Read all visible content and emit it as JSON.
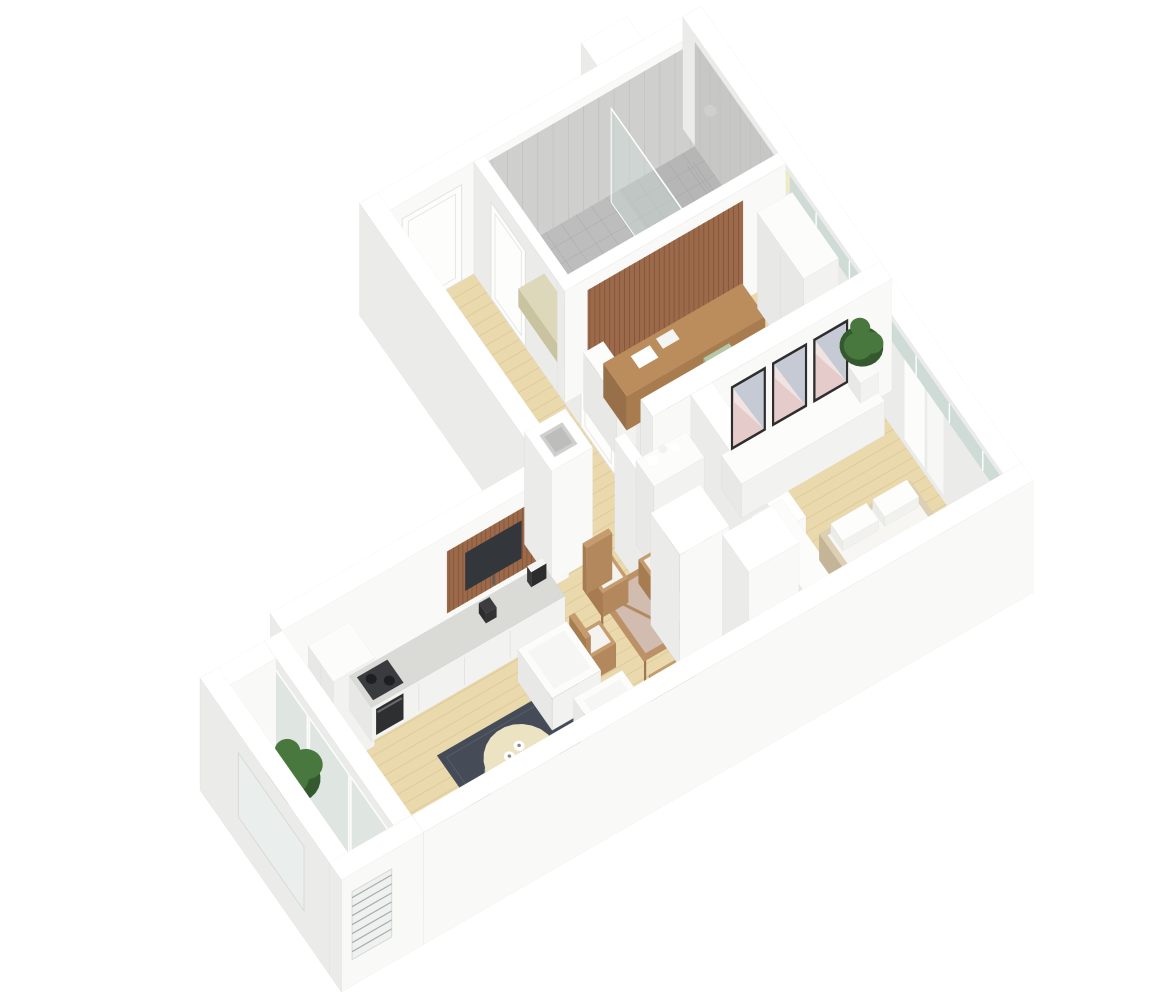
{
  "page": {
    "title": "3D isometric apartment floor plan render"
  },
  "scene": {
    "background": "#ffffff",
    "rooms": [
      {
        "name": "hallway",
        "furniture": [
          "entry-door",
          "bathroom-door",
          "study-door",
          "installation-shaft"
        ]
      },
      {
        "name": "bathroom",
        "furniture": [
          "gray-tile-floor",
          "tile-walls",
          "shower-head",
          "glass-screen",
          "bench-shelf",
          "wall-niche",
          "drain"
        ]
      },
      {
        "name": "study",
        "furniture": [
          "wood-slat-panel",
          "desk",
          "desk-papers",
          "green-chair",
          "green-chair",
          "wardrobe",
          "bench"
        ]
      },
      {
        "name": "wc",
        "furniture": [
          "tall-cabinet",
          "washbasin",
          "toilet",
          "washing-machine",
          "terracotta-floor"
        ]
      },
      {
        "name": "bedroom",
        "furniture": [
          "sideboard",
          "art-frame",
          "art-frame",
          "art-frame",
          "potted-plant",
          "low-bench",
          "double-bed",
          "pillows",
          "curtains",
          "window-strip"
        ]
      },
      {
        "name": "living-room-kitchen",
        "furniture": [
          "tall-kitchen-cabinet",
          "kitchen-counter",
          "oven",
          "cooktop",
          "kettle",
          "photo-frame",
          "wood-slat-panel",
          "tv",
          "dining-table",
          "rattan-chair",
          "rattan-chair",
          "rattan-chair",
          "rattan-chair",
          "armchair",
          "armchair",
          "dark-rug",
          "round-coffee-table",
          "cups"
        ]
      },
      {
        "name": "balcony",
        "furniture": [
          "potted-plant",
          "louver-window",
          "glass-doors",
          "parapet-walls"
        ]
      }
    ],
    "colors": {
      "background": "#ffffff",
      "wallTop": "#ffffff",
      "wallSouth": "#f9f9f8",
      "wallWest": "#ebebe9",
      "wallEdge": "rgba(0,0,0,0.045)",
      "furnTop": "#fcfcfb",
      "furnSouth": "#f2f2f0",
      "furnWest": "#e8e8e6",
      "woodFloor": "#ead9ac",
      "woodLine": "#d8c18c",
      "tileFloor": "#bdbdbd",
      "tileLine": "#acacac",
      "tileWall": "#cfcfcd",
      "tileWall2": "#c7c7c5",
      "tileWallLine": "#c0c0be",
      "wetZone": "rgba(150,150,150,0.16)",
      "wcFloor": "#d7a184",
      "wcLine": "#c69175",
      "balconyFloor": "#f1f1ee",
      "balconyLine": "#e4e4e0",
      "glass": "rgba(213,226,221,0.55)",
      "glassStrip": "#ccdad6",
      "glassSliver": "#f0ebc4",
      "mullion": "#ffffff",
      "rug": "#454c58",
      "rugEdge": "#565d69",
      "coffeeTableTop": "#ece3c3",
      "coffeeTableSide": "#d9d0af",
      "slatWood": "#9c6a4a",
      "slatGap": "#7a5136",
      "deskTop": "#bb8d5d",
      "deskSouth": "#a87c4e",
      "deskWest": "#977049",
      "deskLeg": "#9b7850",
      "tableWood": "#bc9168",
      "tableGlass": "rgba(215,198,192,0.8)",
      "chairGreen": "#b6c9a7",
      "chairGreenSide": "#a3b894",
      "chairGreenWest": "#96ac87",
      "rattan": "#c69c6e",
      "rattanSide": "#b3885c",
      "rattanWest": "#a67c50",
      "cushion": "#f4f3ef",
      "tv": "#33363a",
      "oven": "#2e2f31",
      "cooktop": "#3a3b3e",
      "applianceDark": "#3c3c3e",
      "framePhoto": "#2c2c2c",
      "bedFrame": "#dccfb4",
      "bedSide": "#cfc1a4",
      "bedWest": "#c4b598",
      "mattress": "#f7f6f2",
      "pillow": "#fdfdfb",
      "blanket": "#f0ece1",
      "artFrame": "#2e2e2e",
      "artPink": "#e5cbca",
      "artBlue": "#c5cad4",
      "artLight": "#efe4e2",
      "plant": "#49783f",
      "plantDark": "#35592e",
      "pot": "#fafaf8",
      "beige": "#ded8bb",
      "beigeSide": "#d3cdab",
      "beigeWest": "#c9c39f",
      "shower": "#c6c6c4",
      "showerHead": "#cfcfcd",
      "louver": "#a7adab",
      "shaftHole": "#cfcfcd",
      "shaftHoleDeep": "#bdbdbb",
      "doorFace": "#fdfdfc",
      "doorEdge": "#e2e2e0"
    }
  }
}
